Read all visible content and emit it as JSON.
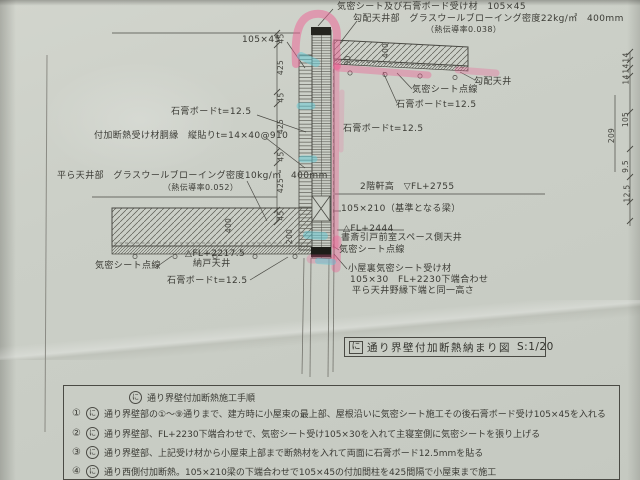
{
  "document_type": "construction detail drawing (photographed paper)",
  "drawing": {
    "labels": {
      "receiver_105x45": "気密シート及び石膏ボード受け材　105×45",
      "slope_gw": "勾配天井部　グラスウールブローイング密度22kg/㎥　400mm",
      "slope_gw_lambda": "（熱伝導率0.038）",
      "stud_105x45": "105×45",
      "airtight_dots_right": "気密シート点線",
      "slope_ceiling": "勾配天井",
      "gypsum_right_ceiling": "石膏ボードt=12.5",
      "gypsum_wall_left": "石膏ボードt=12.5",
      "gypsum_wall_right": "石膏ボードt=12.5",
      "furring": "付加断熱受け材胴縁　縦貼りt=14×40@910",
      "flat_gw": "平ら天井部　グラスウールブローイング密度10kg/㎥　400mm",
      "flat_gw_lambda": "（熱伝導率0.052）",
      "eaves_height": "2階軒高　▽FL+2755",
      "beam_105x210": "105×210（基準となる梁）",
      "fl2444": "△FL+2444",
      "study_ceiling": "書斎引戸前室スペース側天井",
      "airtight_dots_mid": "気密シート点線",
      "attic_receiver1": "小屋裏気密シート受け材",
      "attic_receiver2": "105×30　FL+2230下端合わせ",
      "attic_receiver3": "平ら天井野縁下端と同一高さ",
      "airtight_dots_left": "気密シート点線",
      "fl22175": "△FL+2217.5",
      "closet_ceiling": "納戸天井",
      "gypsum_left_ceiling": "石膏ボードt=12.5"
    },
    "dims": {
      "left_chain": [
        "45",
        "425",
        "45",
        "425",
        "45",
        "425",
        "45"
      ],
      "slope_ceiling_thk": "400",
      "slope_ceiling_step": "50",
      "flat_ceiling_thk": "400",
      "flat_ceiling_edge": "200",
      "right_total": "209",
      "right_stud": "105",
      "right_furring": [
        "14",
        "14",
        "14"
      ],
      "right_board_a": "9.5",
      "right_board_b": "12.5"
    },
    "title": {
      "marker": "に",
      "name": "通り界壁付加断熱納まり図",
      "scale": "S:1/20"
    }
  },
  "table": {
    "header": {
      "marker": "に",
      "text": "通り界壁付加断熱施工手順"
    },
    "rows": [
      {
        "num": "①",
        "marker": "に",
        "text": "通り界壁部の①～⑨通りまで、建方時に小屋束の最上部、屋根沿いに気密シート施工その後石膏ボード受け105×45を入れる"
      },
      {
        "num": "②",
        "marker": "に",
        "text": "通り界壁部、FL+2230下端合わせで、気密シート受け105×30を入れて主寝室側に気密シートを張り上げる"
      },
      {
        "num": "③",
        "marker": "に",
        "text": "通り界壁部、上記受け材から小屋束上部まで断熱材を入れて両面に石膏ボード12.5mmを貼る"
      },
      {
        "num": "④",
        "marker": "に",
        "text": "通り西側付加断熱。105×210梁の下端合わせで105×45の付加間柱を425間隔で小屋束まで施工"
      }
    ]
  },
  "colors": {
    "paper": "#cbcfc7",
    "line": "#4a4a44",
    "highlight_pink": "#ee5f94",
    "highlight_cyan": "#5fc9d5"
  }
}
